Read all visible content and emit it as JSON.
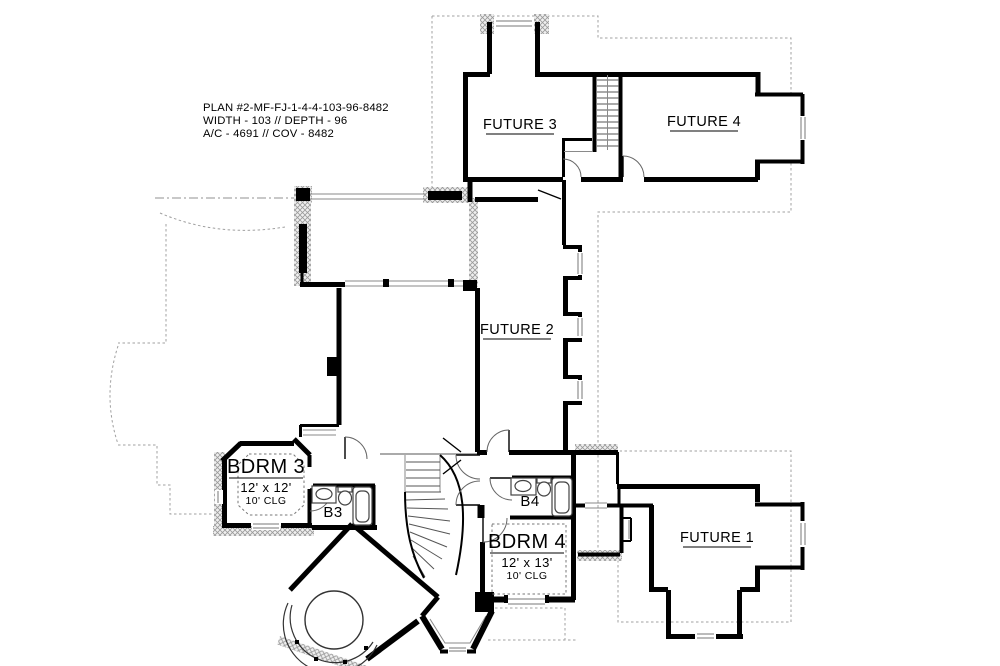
{
  "plan_info": {
    "line1": "PLAN #2-MF-FJ-1-4-4-103-96-8482",
    "line2": "WIDTH - 103 // DEPTH - 96",
    "line3": "A/C - 4691 // COV - 8482"
  },
  "rooms": {
    "future3": {
      "label": "FUTURE 3"
    },
    "future4": {
      "label": "FUTURE 4"
    },
    "future2": {
      "label": "FUTURE 2"
    },
    "future1": {
      "label": "FUTURE 1"
    },
    "bdrm3": {
      "label": "BDRM 3",
      "size": "12' x 12'",
      "ceiling": "10' CLG"
    },
    "bdrm4": {
      "label": "BDRM 4",
      "size": "12' x 13'",
      "ceiling": "10' CLG"
    },
    "bath3": {
      "label": "B3"
    },
    "bath4": {
      "label": "B4"
    }
  },
  "colors": {
    "wall": "#000000",
    "hatch_line": "#9a9a9a",
    "hatch_bg": "#efefef",
    "roofline": "#a0a0a0",
    "background": "#ffffff"
  }
}
